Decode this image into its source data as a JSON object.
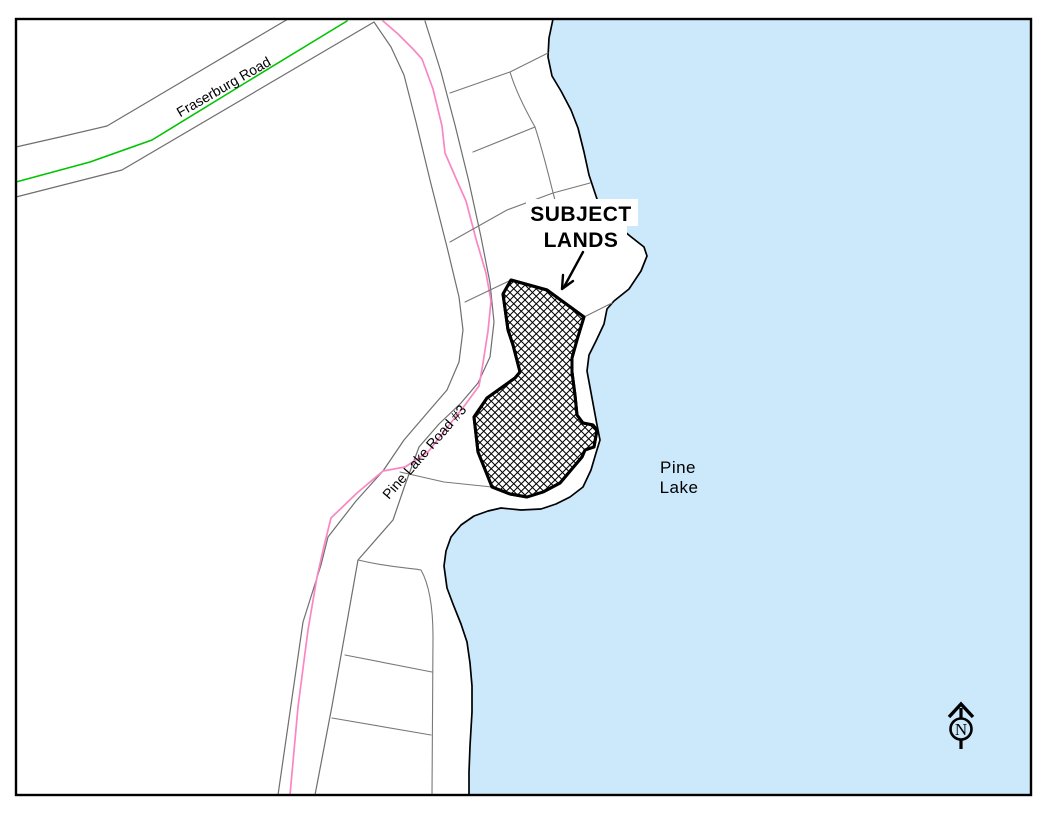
{
  "map": {
    "labels": {
      "fraserburg_road": "Fraserburg Road",
      "pine_lake_road": "Pine Lake Road #3",
      "subject_lands_line1": "SUBJECT",
      "subject_lands_line2": "LANDS",
      "pine_lake_line1": "Pine",
      "pine_lake_line2": "Lake",
      "north_letter": "N"
    },
    "colors": {
      "water": "#CBE9FB",
      "land": "#FFFFFF",
      "shoreline": "#000000",
      "road_edge": "#6E6E6E",
      "parcel_line": "#787878",
      "centerline_green": "#00C400",
      "highlight_pink": "#FA86C4",
      "subject_outline": "#000000",
      "frame": "#000000",
      "text": "#000000"
    }
  }
}
